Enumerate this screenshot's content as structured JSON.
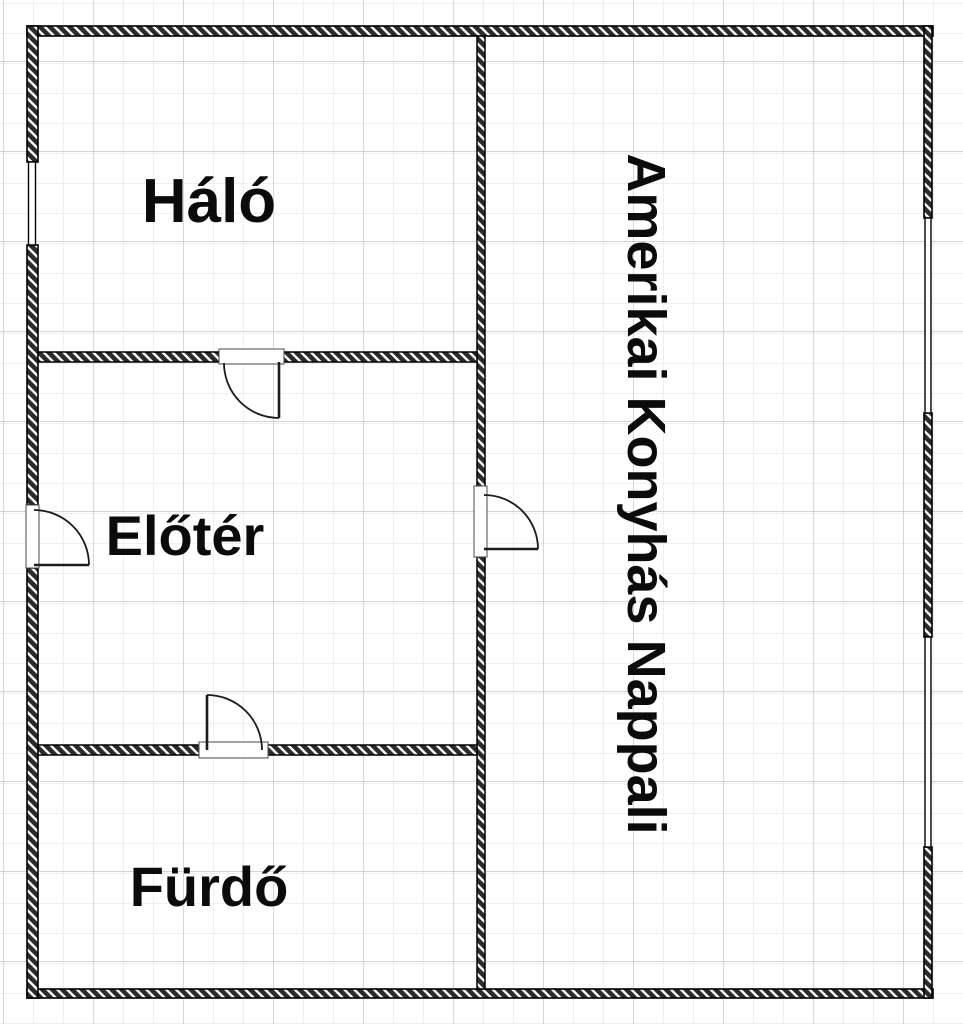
{
  "plan": {
    "title": "floor-plan",
    "rooms": [
      {
        "id": "halo",
        "label": "Háló"
      },
      {
        "id": "eloter",
        "label": "Előtér"
      },
      {
        "id": "furdo",
        "label": "Fürdő"
      },
      {
        "id": "nappali",
        "label": "Amerikai Konyhás Nappali"
      }
    ],
    "doors": [
      {
        "between": "halo-eloter",
        "wall": "horizontal-top-of-eloter"
      },
      {
        "between": "outside-eloter",
        "wall": "left-exterior"
      },
      {
        "between": "eloter-nappali",
        "wall": "middle-vertical"
      },
      {
        "between": "eloter-furdo",
        "wall": "horizontal-bottom-of-eloter"
      }
    ],
    "windows": [
      {
        "on": "left-exterior-wall-halo"
      },
      {
        "on": "right-exterior-wall-upper"
      },
      {
        "on": "right-exterior-wall-lower"
      }
    ]
  },
  "colors": {
    "background": "#ffffff",
    "grid_minor": "#e2e2e2",
    "grid_major": "#c6c6c6",
    "wall_stroke": "#000000",
    "wall_hatch": "#2b2b2b",
    "door_line": "#1c1c1c",
    "label_text": "#0b0b0b"
  }
}
